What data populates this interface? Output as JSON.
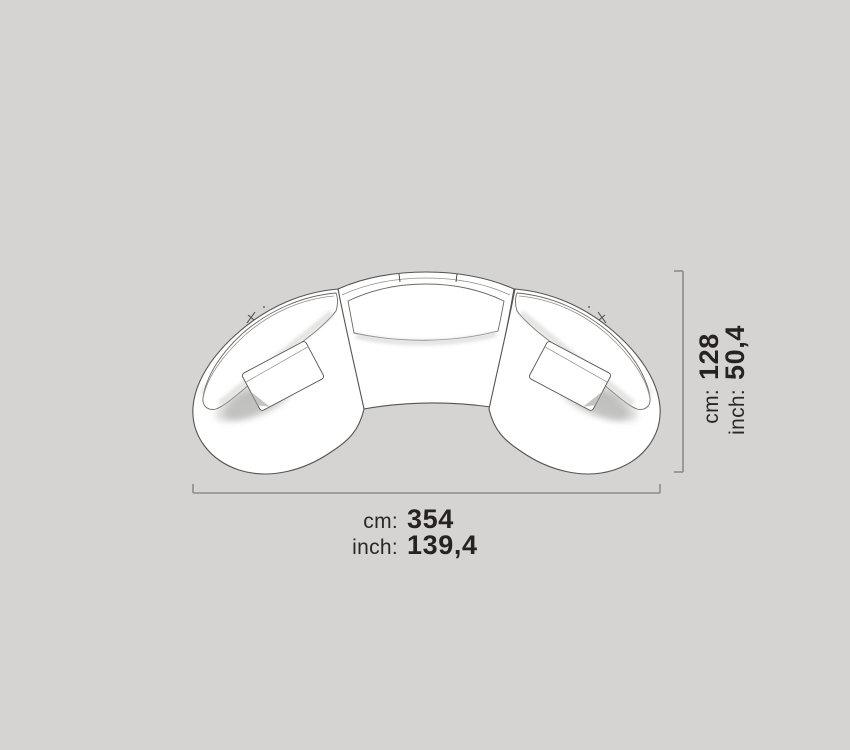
{
  "page": {
    "background_color": "#d5d4d3",
    "content": "top-view dimension diagram of a curved three-module sectional sofa"
  },
  "colors": {
    "sofa_outline": "#56544f",
    "sofa_fill": "#ffffff",
    "dimension_line": "#8c8b89",
    "label_text": "#2c2722",
    "value_text": "#272220"
  },
  "sofa": {
    "modules": [
      "left-curved-module",
      "center-curved-bench",
      "right-curved-module"
    ],
    "pillow_count": 2
  },
  "dimensions": {
    "width": {
      "rows": [
        {
          "unit": "cm:",
          "value": "354"
        },
        {
          "unit": "inch:",
          "value": "139,4"
        }
      ]
    },
    "height": {
      "rows": [
        {
          "unit": "cm:",
          "value": "128"
        },
        {
          "unit": "inch:",
          "value": "50,4"
        }
      ]
    }
  }
}
